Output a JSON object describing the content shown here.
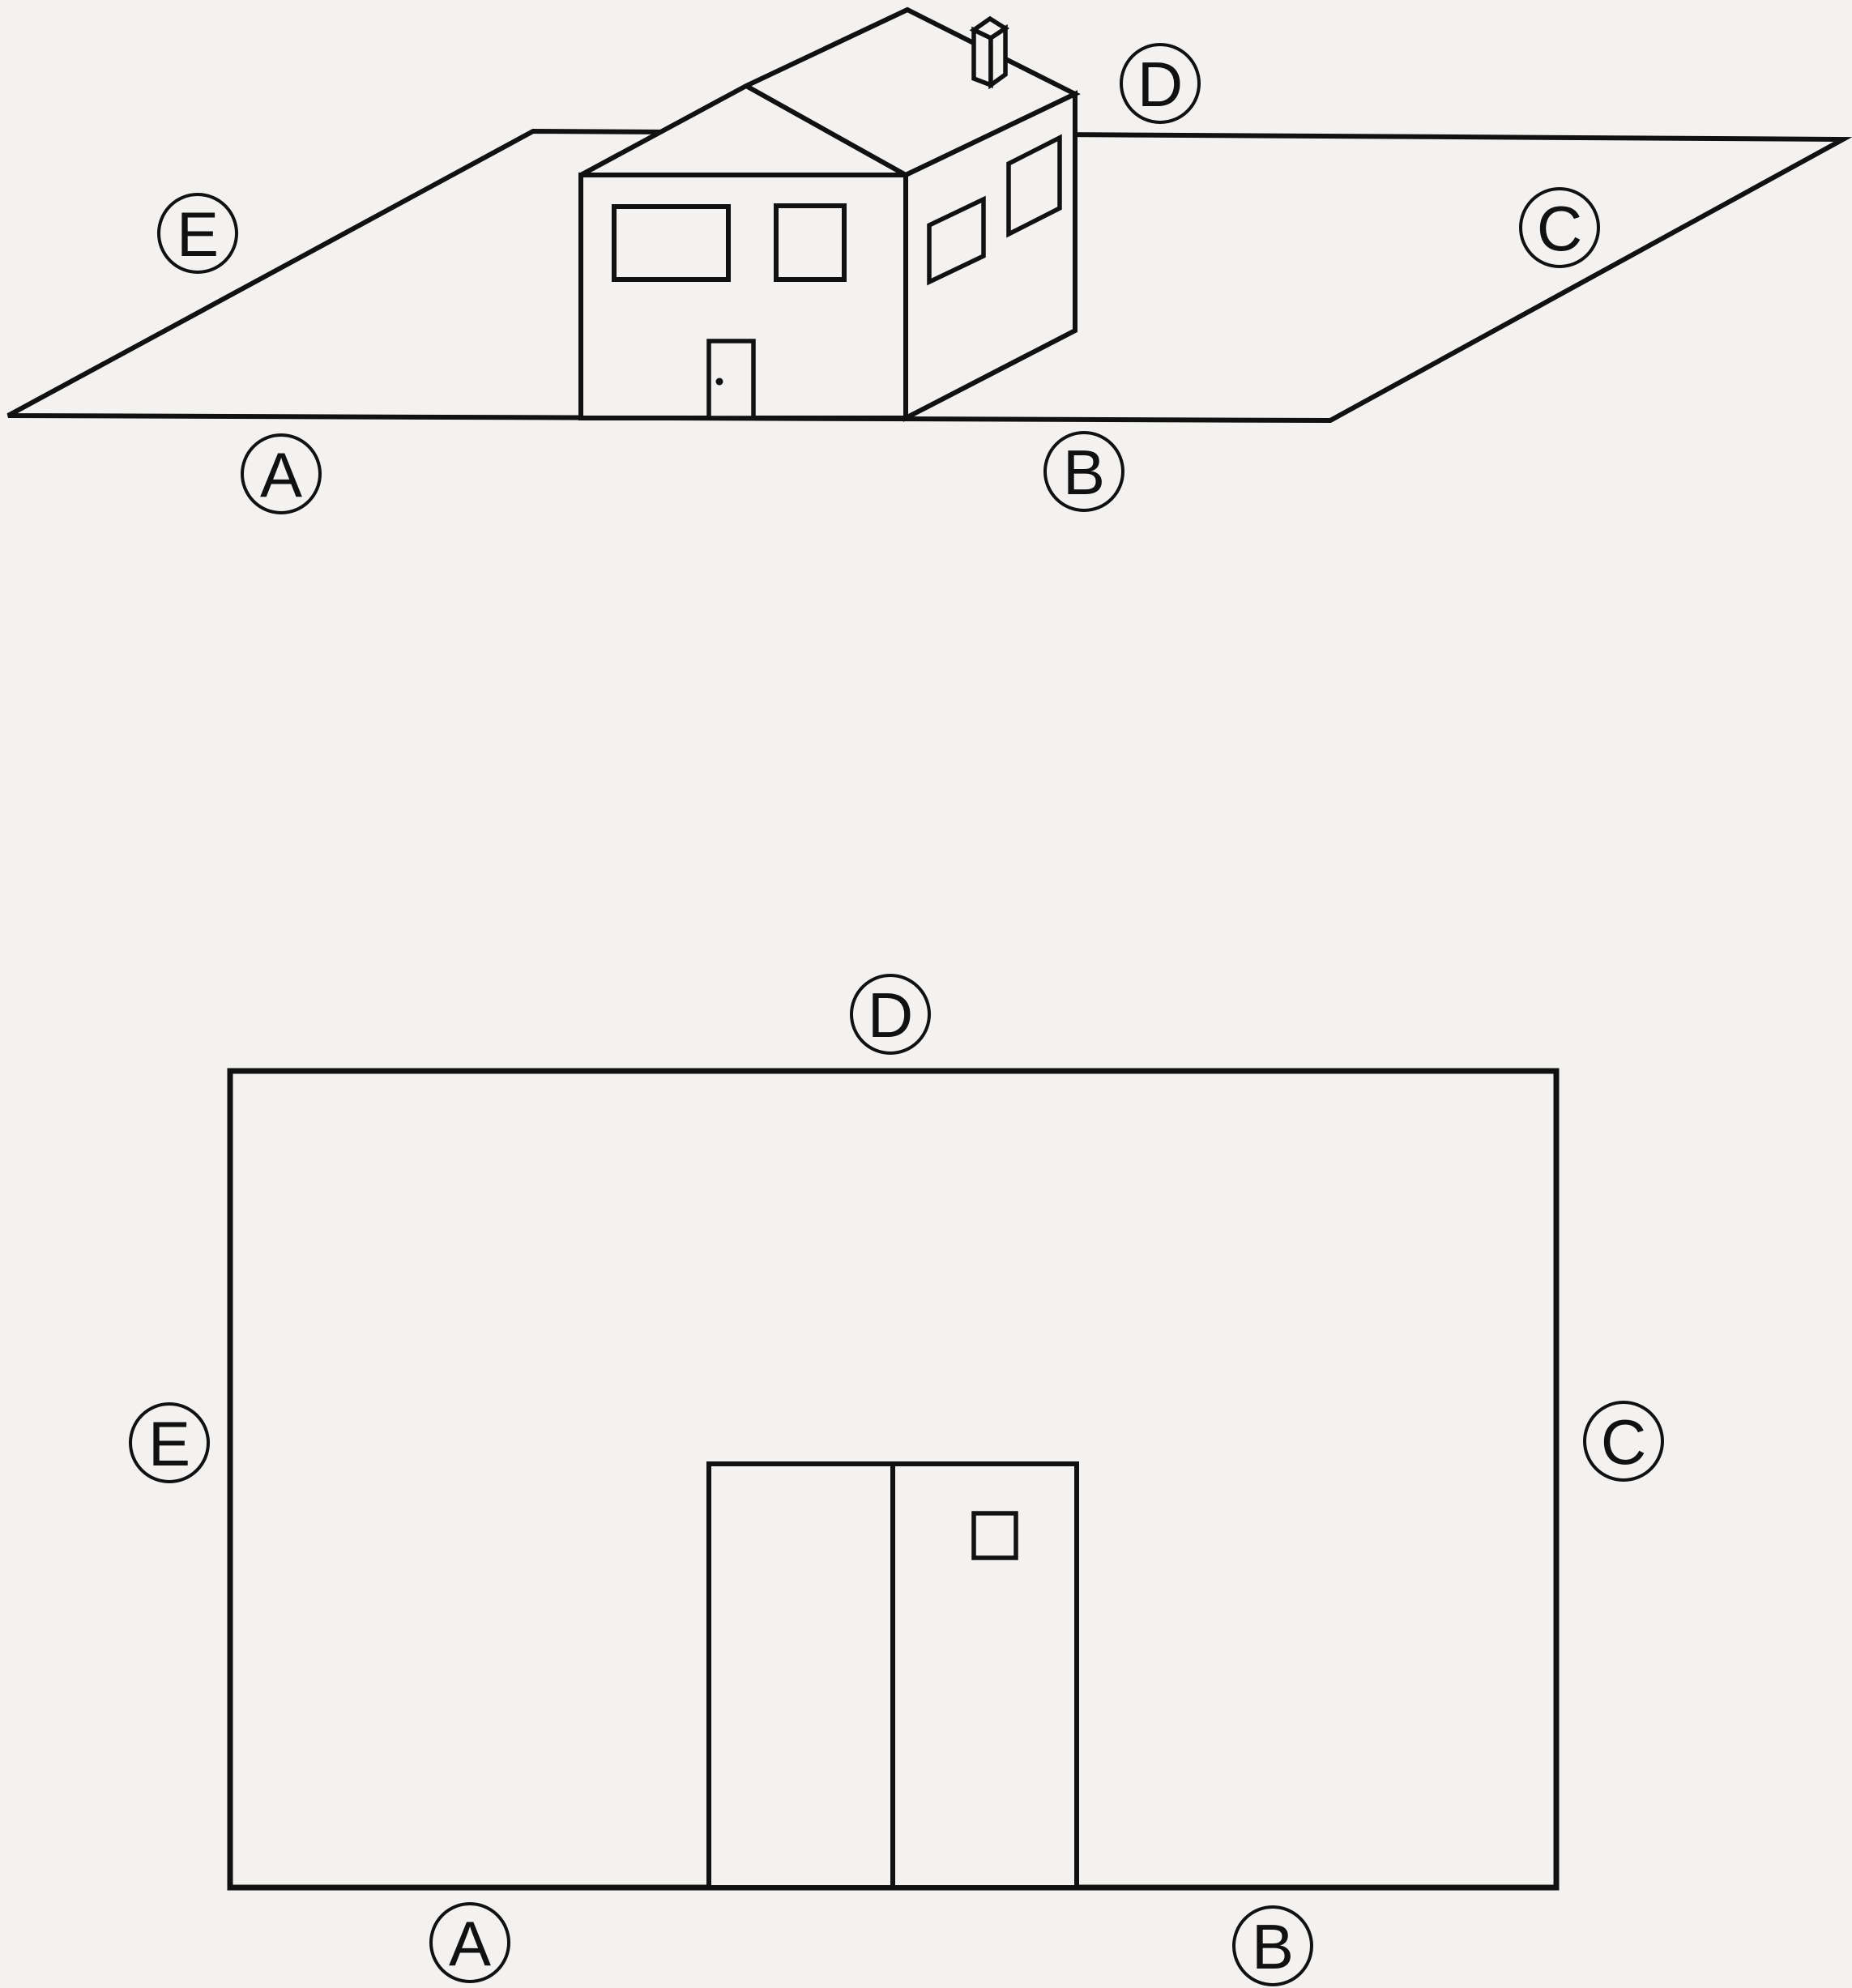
{
  "colors": {
    "background": "#f3f2f0",
    "line": "#111111"
  },
  "top_diagram": {
    "title": "house-perspective-view",
    "labels": [
      {
        "letter": "E"
      },
      {
        "letter": "A"
      },
      {
        "letter": "B"
      },
      {
        "letter": "D"
      },
      {
        "letter": "C"
      }
    ]
  },
  "bottom_diagram": {
    "title": "house-front-elevation-view",
    "labels": [
      {
        "letter": "D"
      },
      {
        "letter": "E"
      },
      {
        "letter": "C"
      },
      {
        "letter": "A"
      },
      {
        "letter": "B"
      }
    ]
  }
}
